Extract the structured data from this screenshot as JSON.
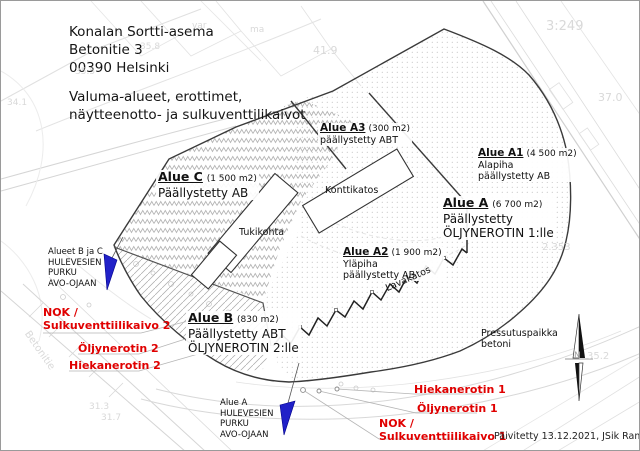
{
  "document": {
    "title_lines": [
      "Konalan Sortti-asema",
      "Betonitie 3",
      "00390 Helsinki"
    ],
    "subtitle_lines": [
      "Valuma-alueet, erottimet,",
      "näytteenotto- ja sulkuventtilikaivot"
    ],
    "footer": "Päivitetty 13.12.2021, JSik Ramboll"
  },
  "areas": {
    "c": {
      "name": "Alue C",
      "size": "(1 500 m2)",
      "desc1": "Päällystetty AB"
    },
    "b": {
      "name": "Alue B",
      "size": "(830 m2)",
      "desc1": "Päällystetty ABT",
      "desc2": "ÖLJYNEROTIN 2:lle"
    },
    "a": {
      "name": "Alue A",
      "size": "(6 700 m2)",
      "desc1": "Päällystetty",
      "desc2": "ÖLJYNEROTIN 1:lle"
    },
    "a1": {
      "name": "Alue A1",
      "size": "(4 500 m2)",
      "desc1": "Alapiha",
      "desc2": "päällystetty AB"
    },
    "a2": {
      "name": "Alue A2",
      "size": "(1 900 m2)",
      "desc1": "Yläpiha",
      "desc2": "päällystetty AB"
    },
    "a3": {
      "name": "Alue A3",
      "size": "(300 m2)",
      "desc1": "päällystetty ABT"
    }
  },
  "buildings": {
    "tukikohta": "Tukikohta",
    "konttikatos": "Konttikatos",
    "lavakatos": "Lavakatos",
    "pressutuspaikka_line1": "Pressutuspaikka",
    "pressutuspaikka_line2": "betoni"
  },
  "discharge_notes": {
    "bc": {
      "line1": "Alueet B ja C",
      "line2": "HULEVESIEN",
      "line3": "PURKU",
      "line4": "AVO-OJAAN"
    },
    "a": {
      "line1": "Alue A",
      "line2": "HULEVESIEN",
      "line3": "PURKU",
      "line4": "AVO-OJAAN"
    }
  },
  "red_labels": {
    "nok2_line1": "NOK /",
    "nok2_line2": "Sulkuventtiilikaivo 2",
    "oil2": "Öljynerotin 2",
    "sand2": "Hiekanerotin 2",
    "sand1": "Hiekanerotin 1",
    "oil1": "Öljynerotin 1",
    "nok1_line1": "NOK /",
    "nok1_line2": "Sulkuventtiilikaivo 1"
  },
  "bg_labels": [
    {
      "text": "3:249"
    },
    {
      "text": "37.0"
    },
    {
      "text": "41.9"
    },
    {
      "text": "35.8"
    },
    {
      "text": "35.5"
    },
    {
      "text": "34.1"
    },
    {
      "text": "2.353"
    },
    {
      "text": "35.2"
    },
    {
      "text": "31.3"
    },
    {
      "text": "31.7"
    },
    {
      "text": "Betonitie"
    },
    {
      "text": "var"
    },
    {
      "text": "ma"
    }
  ],
  "compass": {
    "n": "N"
  },
  "colors": {
    "red": "#e00000",
    "blue": "#2121c8",
    "boundary": "#3a3a3a"
  }
}
